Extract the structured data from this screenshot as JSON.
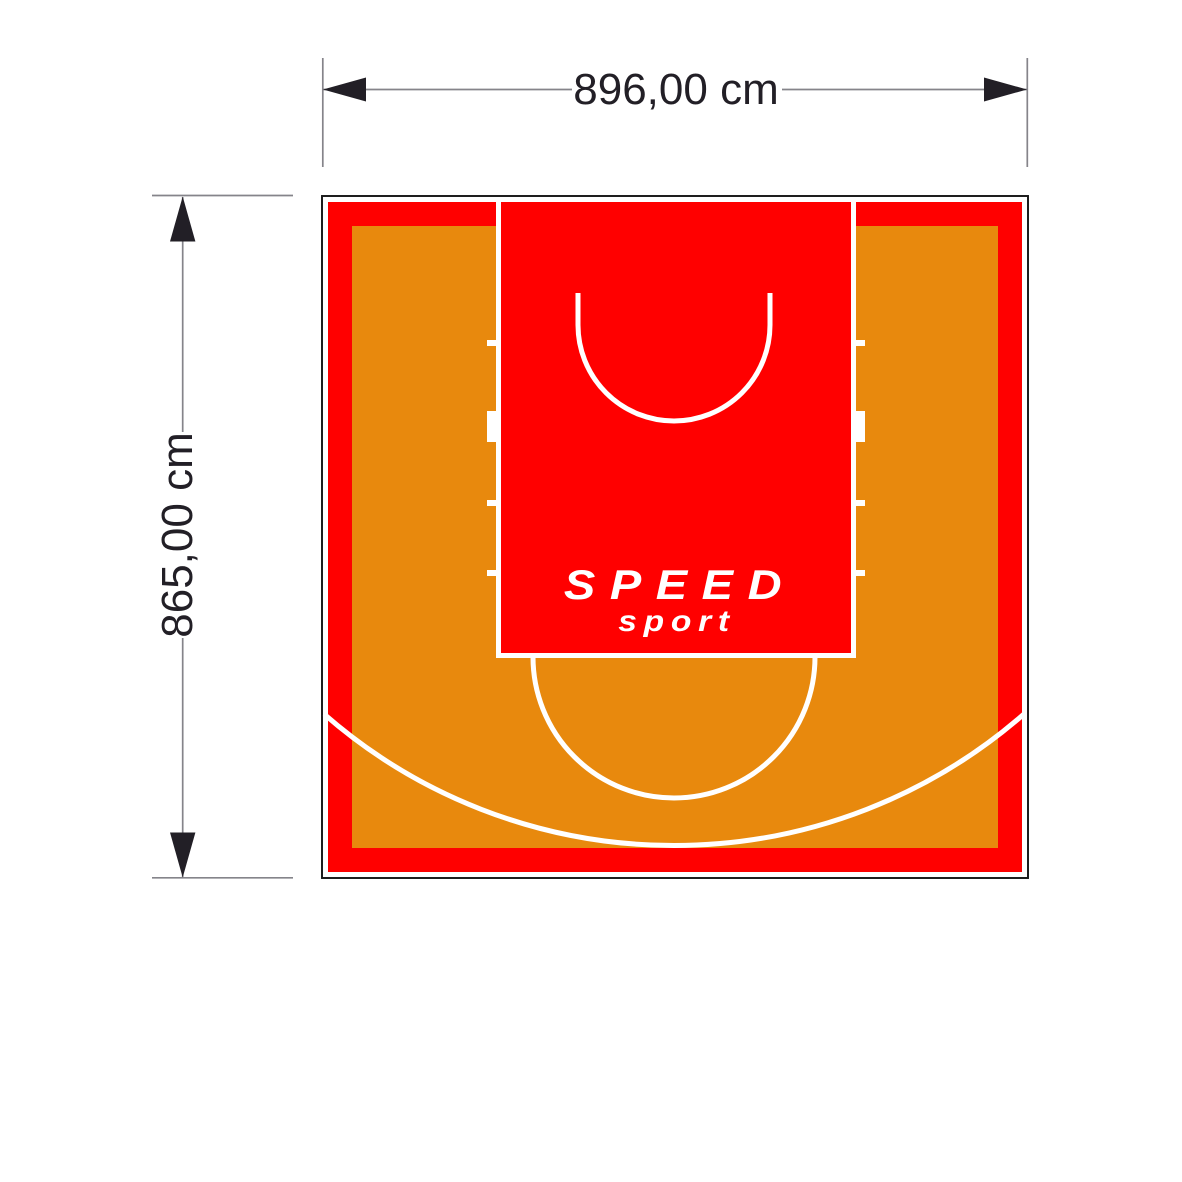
{
  "dimensions": {
    "width": {
      "label": "896,00 cm"
    },
    "height": {
      "label": "865,00 cm"
    }
  },
  "logo": {
    "line1": "SPEED",
    "line2": "sport"
  },
  "colors": {
    "page_background": "#FFFFFF",
    "court_red": "#FF0000",
    "court_orange": "#E8890D",
    "court_line_white": "#FFFFFF",
    "court_outline": "#1A1A1A",
    "dim_line_gray": "#85848A",
    "dim_dark": "#221F26"
  }
}
